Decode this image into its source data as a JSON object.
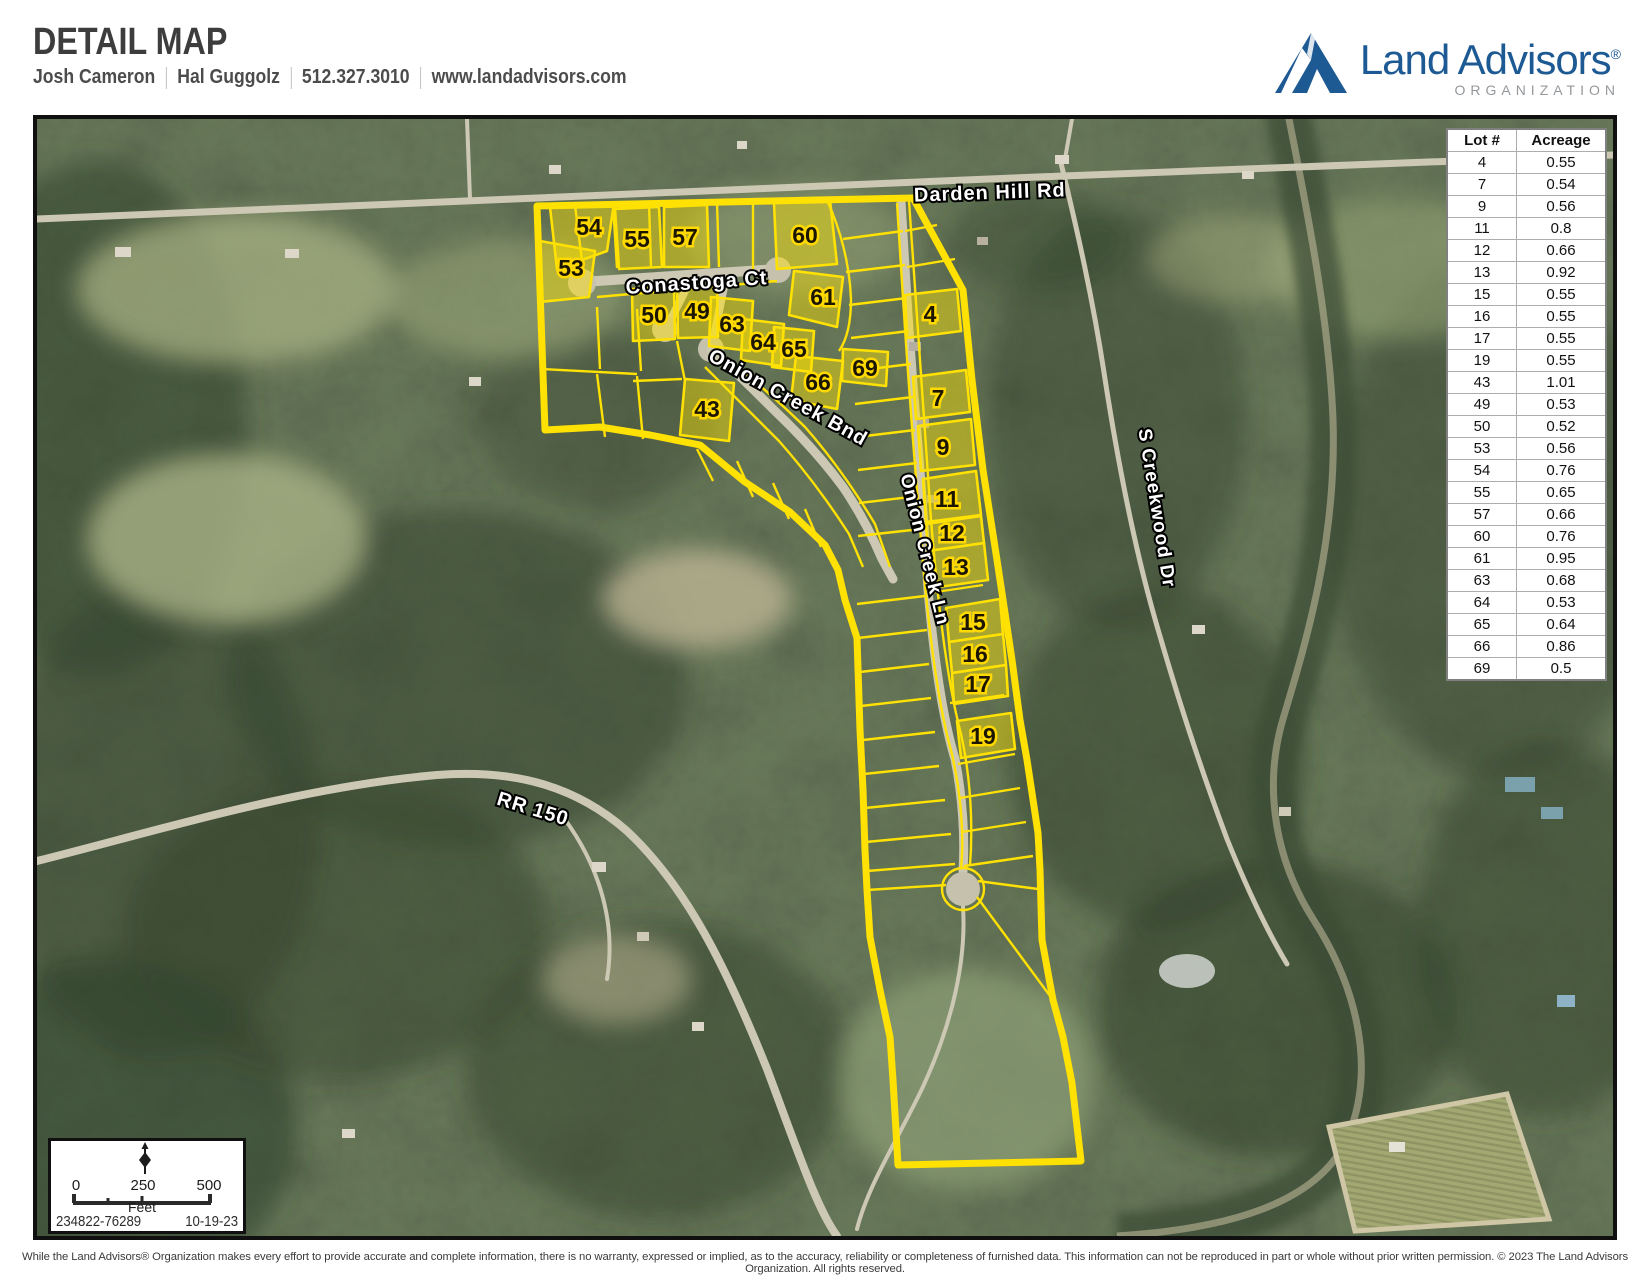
{
  "header": {
    "title": "DETAIL MAP",
    "agent1": "Josh Cameron",
    "agent2": "Hal Guggolz",
    "phone": "512.327.3010",
    "website": "www.landadvisors.com"
  },
  "logo": {
    "brand": "Land Advisors",
    "reg": "®",
    "org": "ORGANIZATION",
    "brand_color": "#1d5a94"
  },
  "map": {
    "boundary_color": "#ffe103",
    "streets": [
      "Darden Hill Rd",
      "Conastoga Ct",
      "Onion Creek Bnd",
      "Onion Creek Ln",
      "S Creekwood Dr",
      "RR 150"
    ],
    "lot_labels": [
      "54",
      "53",
      "55",
      "57",
      "60",
      "61",
      "50",
      "49",
      "63",
      "64",
      "65",
      "69",
      "66",
      "43",
      "4",
      "7",
      "9",
      "11",
      "12",
      "13",
      "15",
      "16",
      "17",
      "19"
    ]
  },
  "lot_table": {
    "headers": [
      "Lot #",
      "Acreage"
    ],
    "rows": [
      [
        "4",
        "0.55"
      ],
      [
        "7",
        "0.54"
      ],
      [
        "9",
        "0.56"
      ],
      [
        "11",
        "0.8"
      ],
      [
        "12",
        "0.66"
      ],
      [
        "13",
        "0.92"
      ],
      [
        "15",
        "0.55"
      ],
      [
        "16",
        "0.55"
      ],
      [
        "17",
        "0.55"
      ],
      [
        "19",
        "0.55"
      ],
      [
        "43",
        "1.01"
      ],
      [
        "49",
        "0.53"
      ],
      [
        "50",
        "0.52"
      ],
      [
        "53",
        "0.56"
      ],
      [
        "54",
        "0.76"
      ],
      [
        "55",
        "0.65"
      ],
      [
        "57",
        "0.66"
      ],
      [
        "60",
        "0.76"
      ],
      [
        "61",
        "0.95"
      ],
      [
        "63",
        "0.68"
      ],
      [
        "64",
        "0.53"
      ],
      [
        "65",
        "0.64"
      ],
      [
        "66",
        "0.86"
      ],
      [
        "69",
        "0.5"
      ]
    ]
  },
  "scale_bar": {
    "ticks": [
      "0",
      "250",
      "500"
    ],
    "unit": "Feet",
    "map_number": "234822-76289",
    "date": "10-19-23"
  },
  "footer": {
    "disclaimer": "While the Land Advisors® Organization makes every effort to provide accurate and complete information, there is no warranty, expressed or implied, as to the accuracy, reliability or completeness of furnished data. This information can not be reproduced in part or whole without prior written permission. © 2023 The Land Advisors Organization. All rights reserved."
  }
}
